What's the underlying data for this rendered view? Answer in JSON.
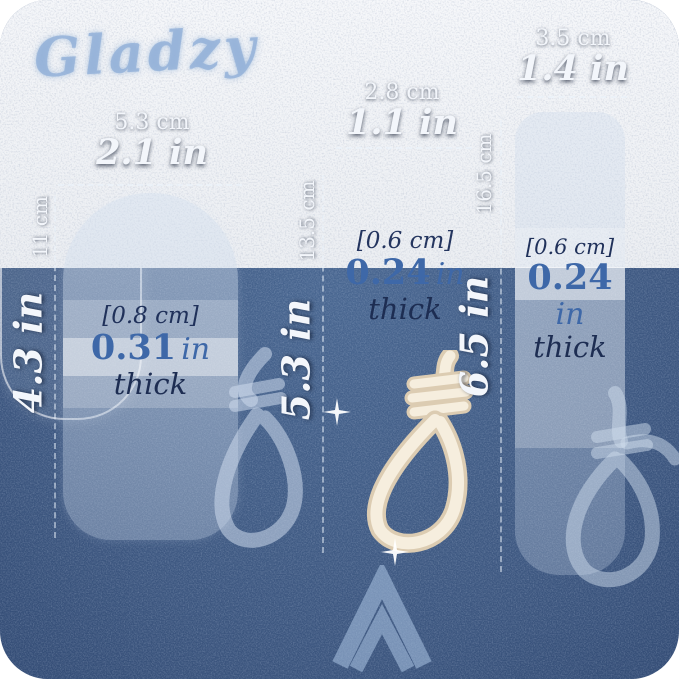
{
  "brand": "Gladzy",
  "colors": {
    "background_mid": "#3c567f",
    "background_edge": "#1e3256",
    "thickness_value_blue": "#3e68a8",
    "thickness_navy": "#1d2d52",
    "label_white": "#f3f6fb",
    "rope_cream": "#f6eede",
    "ghost_blue": "#cdd9ec"
  },
  "icons": {
    "chevron": "chevron-up-icon",
    "sparkle": "sparkle-icon"
  },
  "files": [
    {
      "id": "wide",
      "width_cm": "5.3 cm",
      "width_in": "2.1 in",
      "height_cm": "11 cm",
      "height_in": "4.3 in",
      "thickness_cm": "[0.8 cm]",
      "thickness_in_value": "0.31",
      "thickness_in_unit": "in",
      "thickness_word": "thick"
    },
    {
      "id": "slim",
      "width_cm": "2.8 cm",
      "width_in": "1.1 in",
      "height_cm": "13.5 cm",
      "height_in": "5.3 in",
      "thickness_cm": "[0.6 cm]",
      "thickness_in_value": "0.24",
      "thickness_in_unit": "in",
      "thickness_word": "thick"
    },
    {
      "id": "tall",
      "width_cm": "3.5 cm",
      "width_in": "1.4 in",
      "height_cm": "16.5 cm",
      "height_in": "6.5 in",
      "thickness_cm": "[0.6 cm]",
      "thickness_in_value": "0.24",
      "thickness_in_unit": "in",
      "thickness_word": "thick"
    }
  ]
}
